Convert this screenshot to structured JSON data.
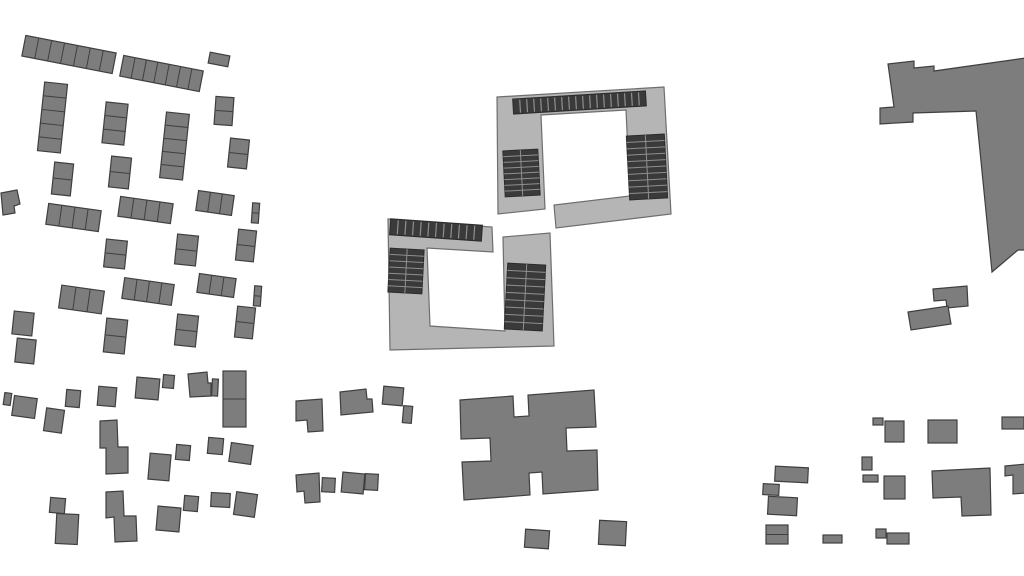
{
  "map": {
    "kind": "building-footprint-site-plan",
    "width": 1024,
    "height": 576,
    "background": "#ffffff"
  },
  "colors": {
    "building_fill": "#7d7d7d",
    "building_stroke": "#3f3f3f",
    "court_fill": "#b5b5b5",
    "court_stroke": "#6e6e6e",
    "panel_fill": "#3a3a3a",
    "panel_stroke": "#2b2b2b",
    "panel_divider": "#8f8f8f",
    "cell_divider": "#3f3f3f"
  },
  "buildings": [
    {
      "kind": "rect",
      "name": "terrace-row",
      "x": 23,
      "y": 44,
      "w": 92,
      "h": 21,
      "rot": 11,
      "cells": 7,
      "dir": "h"
    },
    {
      "kind": "rect",
      "name": "terrace-row",
      "x": 121,
      "y": 63,
      "w": 81,
      "h": 21,
      "rot": 11,
      "cells": 7,
      "dir": "h"
    },
    {
      "kind": "rect",
      "name": "detached-house",
      "x": 209,
      "y": 54,
      "w": 20,
      "h": 11,
      "rot": 11,
      "cells": 1,
      "dir": "h"
    },
    {
      "kind": "rect",
      "name": "terrace-column",
      "x": 41,
      "y": 83,
      "w": 23,
      "h": 69,
      "rot": 6,
      "cells": 5,
      "dir": "v"
    },
    {
      "kind": "rect",
      "name": "terrace-column",
      "x": 104,
      "y": 103,
      "w": 22,
      "h": 41,
      "rot": 6,
      "cells": 3,
      "dir": "v"
    },
    {
      "kind": "rect",
      "name": "terrace-column",
      "x": 163,
      "y": 113,
      "w": 23,
      "h": 66,
      "rot": 6,
      "cells": 5,
      "dir": "v"
    },
    {
      "kind": "rect",
      "name": "terrace-column",
      "x": 215,
      "y": 97,
      "w": 18,
      "h": 28,
      "rot": 4,
      "cells": 2,
      "dir": "v"
    },
    {
      "kind": "rect",
      "name": "terrace-column",
      "x": 229,
      "y": 139,
      "w": 19,
      "h": 29,
      "rot": 6,
      "cells": 2,
      "dir": "v"
    },
    {
      "kind": "rect",
      "name": "terrace-column",
      "x": 53,
      "y": 163,
      "w": 19,
      "h": 32,
      "rot": 6,
      "cells": 2,
      "dir": "v"
    },
    {
      "kind": "rect",
      "name": "terrace-column",
      "x": 110,
      "y": 157,
      "w": 20,
      "h": 31,
      "rot": 6,
      "cells": 2,
      "dir": "v"
    },
    {
      "kind": "rect",
      "name": "terrace-row",
      "x": 197,
      "y": 193,
      "w": 36,
      "h": 20,
      "rot": 8,
      "cells": 3,
      "dir": "h"
    },
    {
      "kind": "rect",
      "name": "terrace-column",
      "x": 252,
      "y": 203,
      "w": 7,
      "h": 20,
      "rot": 4,
      "cells": 2,
      "dir": "v"
    },
    {
      "kind": "rect",
      "name": "terrace-row",
      "x": 47,
      "y": 207,
      "w": 53,
      "h": 21,
      "rot": 8,
      "cells": 4,
      "dir": "h"
    },
    {
      "kind": "rect",
      "name": "terrace-row",
      "x": 119,
      "y": 200,
      "w": 53,
      "h": 20,
      "rot": 8,
      "cells": 4,
      "dir": "h"
    },
    {
      "kind": "rect",
      "name": "terrace-column",
      "x": 105,
      "y": 240,
      "w": 21,
      "h": 28,
      "rot": 6,
      "cells": 2,
      "dir": "v"
    },
    {
      "kind": "rect",
      "name": "terrace-column",
      "x": 176,
      "y": 235,
      "w": 21,
      "h": 30,
      "rot": 6,
      "cells": 2,
      "dir": "v"
    },
    {
      "kind": "rect",
      "name": "terrace-column",
      "x": 237,
      "y": 230,
      "w": 18,
      "h": 31,
      "rot": 6,
      "cells": 2,
      "dir": "v"
    },
    {
      "kind": "rect",
      "name": "terrace-row",
      "x": 60,
      "y": 288,
      "w": 43,
      "h": 23,
      "rot": 8,
      "cells": 3,
      "dir": "h"
    },
    {
      "kind": "rect",
      "name": "terrace-row",
      "x": 123,
      "y": 281,
      "w": 50,
      "h": 21,
      "rot": 8,
      "cells": 4,
      "dir": "h"
    },
    {
      "kind": "rect",
      "name": "terrace-row",
      "x": 198,
      "y": 276,
      "w": 37,
      "h": 19,
      "rot": 8,
      "cells": 3,
      "dir": "h"
    },
    {
      "kind": "rect",
      "name": "terrace-column",
      "x": 254,
      "y": 286,
      "w": 7,
      "h": 20,
      "rot": 4,
      "cells": 2,
      "dir": "v"
    },
    {
      "kind": "rect",
      "name": "detached-house",
      "x": 13,
      "y": 312,
      "w": 20,
      "h": 23,
      "rot": 6,
      "cells": 1,
      "dir": "v"
    },
    {
      "kind": "rect",
      "name": "detached-house",
      "x": 16,
      "y": 339,
      "w": 19,
      "h": 24,
      "rot": 6,
      "cells": 1,
      "dir": "v"
    },
    {
      "kind": "rect",
      "name": "terrace-column",
      "x": 105,
      "y": 319,
      "w": 21,
      "h": 34,
      "rot": 6,
      "cells": 2,
      "dir": "v"
    },
    {
      "kind": "rect",
      "name": "terrace-column",
      "x": 176,
      "y": 315,
      "w": 21,
      "h": 31,
      "rot": 6,
      "cells": 2,
      "dir": "v"
    },
    {
      "kind": "rect",
      "name": "terrace-column",
      "x": 236,
      "y": 307,
      "w": 18,
      "h": 31,
      "rot": 6,
      "cells": 2,
      "dir": "v"
    },
    {
      "kind": "poly",
      "name": "detached-house",
      "pts": [
        [
          1,
          193
        ],
        [
          17,
          190
        ],
        [
          20,
          204
        ],
        [
          14,
          206
        ],
        [
          15,
          213
        ],
        [
          3,
          215
        ]
      ]
    },
    {
      "kind": "poly",
      "name": "courtyard-building-north",
      "fill": "court",
      "pts": [
        [
          497,
          97
        ],
        [
          664,
          87
        ],
        [
          671,
          214
        ],
        [
          556,
          228
        ],
        [
          554,
          205
        ],
        [
          630,
          196
        ],
        [
          626,
          110
        ],
        [
          541,
          115
        ],
        [
          545,
          209
        ],
        [
          498,
          214
        ]
      ]
    },
    {
      "kind": "poly",
      "name": "courtyard-building-south",
      "fill": "court",
      "pts": [
        [
          388,
          219
        ],
        [
          492,
          227
        ],
        [
          493,
          252
        ],
        [
          427,
          248
        ],
        [
          430,
          326
        ],
        [
          505,
          331
        ],
        [
          503,
          237
        ],
        [
          550,
          233
        ],
        [
          554,
          346
        ],
        [
          390,
          350
        ]
      ]
    },
    {
      "kind": "panel-strip",
      "name": "solar-panel-strip-north",
      "x": 513,
      "y": 95,
      "w": 133,
      "h": 15,
      "rot": -3.5,
      "n": 19
    },
    {
      "kind": "panel-block",
      "name": "solar-panel-block-north-west",
      "x": 504,
      "y": 150,
      "w": 35,
      "h": 46,
      "rot": -3,
      "rows": 8,
      "cols": 2
    },
    {
      "kind": "panel-block",
      "name": "solar-panel-block-north-east",
      "x": 628,
      "y": 135,
      "w": 38,
      "h": 64,
      "rot": -3,
      "rows": 10,
      "cols": 2
    },
    {
      "kind": "panel-strip",
      "name": "solar-panel-strip-south",
      "x": 390,
      "y": 222,
      "w": 92,
      "h": 16,
      "rot": 4,
      "n": 12
    },
    {
      "kind": "panel-block",
      "name": "solar-panel-block-south-west",
      "x": 389,
      "y": 249,
      "w": 34,
      "h": 44,
      "rot": 3,
      "rows": 7,
      "cols": 2
    },
    {
      "kind": "panel-block",
      "name": "solar-panel-block-south-east",
      "x": 506,
      "y": 264,
      "w": 38,
      "h": 66,
      "rot": 3,
      "rows": 9,
      "cols": 2
    },
    {
      "kind": "poly",
      "name": "cross-shaped-building",
      "pts": [
        [
          460,
          400
        ],
        [
          513,
          396
        ],
        [
          514,
          417
        ],
        [
          529,
          416
        ],
        [
          528,
          395
        ],
        [
          594,
          390
        ],
        [
          596,
          427
        ],
        [
          566,
          428
        ],
        [
          567,
          451
        ],
        [
          597,
          450
        ],
        [
          598,
          490
        ],
        [
          543,
          494
        ],
        [
          542,
          472
        ],
        [
          529,
          473
        ],
        [
          530,
          495
        ],
        [
          464,
          500
        ],
        [
          462,
          462
        ],
        [
          491,
          461
        ],
        [
          490,
          438
        ],
        [
          461,
          439
        ]
      ]
    },
    {
      "kind": "poly",
      "name": "l-shaped-building-east",
      "pts": [
        [
          888,
          64
        ],
        [
          914,
          61
        ],
        [
          914,
          68
        ],
        [
          934,
          66
        ],
        [
          934,
          71
        ],
        [
          1026,
          58
        ],
        [
          1026,
          250
        ],
        [
          1018,
          250
        ],
        [
          992,
          272
        ],
        [
          976,
          111
        ],
        [
          913,
          113
        ],
        [
          913,
          122
        ],
        [
          880,
          124
        ],
        [
          880,
          108
        ],
        [
          894,
          107
        ]
      ]
    },
    {
      "kind": "poly",
      "name": "annex-building",
      "pts": [
        [
          933,
          289
        ],
        [
          967,
          286
        ],
        [
          968,
          306
        ],
        [
          947,
          308
        ],
        [
          946,
          300
        ],
        [
          934,
          301
        ]
      ]
    },
    {
      "kind": "poly",
      "name": "annex-building",
      "pts": [
        [
          908,
          312
        ],
        [
          948,
          306
        ],
        [
          951,
          324
        ],
        [
          911,
          330
        ]
      ]
    },
    {
      "kind": "rect",
      "name": "detached-house",
      "x": 4,
      "y": 393,
      "w": 7,
      "h": 12,
      "rot": 8
    },
    {
      "kind": "rect",
      "name": "detached-house",
      "x": 13,
      "y": 397,
      "w": 23,
      "h": 20,
      "rot": 8
    },
    {
      "kind": "rect",
      "name": "detached-house",
      "x": 45,
      "y": 409,
      "w": 18,
      "h": 23,
      "rot": 8
    },
    {
      "kind": "rect",
      "name": "detached-house",
      "x": 66,
      "y": 390,
      "w": 14,
      "h": 17,
      "rot": 5
    },
    {
      "kind": "rect",
      "name": "detached-house",
      "x": 98,
      "y": 387,
      "w": 18,
      "h": 19,
      "rot": 5
    },
    {
      "kind": "rect",
      "name": "detached-house",
      "x": 136,
      "y": 378,
      "w": 23,
      "h": 21,
      "rot": 5
    },
    {
      "kind": "rect",
      "name": "detached-house",
      "x": 163,
      "y": 375,
      "w": 11,
      "h": 13,
      "rot": 5
    },
    {
      "kind": "poly",
      "name": "detached-house",
      "pts": [
        [
          188,
          374
        ],
        [
          207,
          372
        ],
        [
          208,
          383
        ],
        [
          211,
          383
        ],
        [
          211,
          396
        ],
        [
          190,
          397
        ]
      ]
    },
    {
      "kind": "rect",
      "name": "detached-house",
      "x": 212,
      "y": 379,
      "w": 6,
      "h": 17,
      "rot": 3
    },
    {
      "kind": "rect",
      "name": "detached-house",
      "x": 223,
      "y": 371,
      "w": 23,
      "h": 56,
      "rot": 0,
      "cells": 2,
      "dir": "v"
    },
    {
      "kind": "poly",
      "name": "detached-house",
      "pts": [
        [
          100,
          421
        ],
        [
          117,
          420
        ],
        [
          118,
          447
        ],
        [
          128,
          447
        ],
        [
          128,
          473
        ],
        [
          106,
          474
        ],
        [
          106,
          448
        ],
        [
          100,
          448
        ]
      ]
    },
    {
      "kind": "rect",
      "name": "detached-house",
      "x": 149,
      "y": 454,
      "w": 21,
      "h": 26,
      "rot": 5
    },
    {
      "kind": "rect",
      "name": "detached-house",
      "x": 176,
      "y": 445,
      "w": 14,
      "h": 15,
      "rot": 5
    },
    {
      "kind": "rect",
      "name": "detached-house",
      "x": 208,
      "y": 438,
      "w": 15,
      "h": 16,
      "rot": 5
    },
    {
      "kind": "rect",
      "name": "detached-house",
      "x": 230,
      "y": 444,
      "w": 22,
      "h": 19,
      "rot": 8
    },
    {
      "kind": "rect",
      "name": "detached-house",
      "x": 50,
      "y": 498,
      "w": 15,
      "h": 15,
      "rot": 5
    },
    {
      "kind": "rect",
      "name": "detached-house",
      "x": 56,
      "y": 514,
      "w": 22,
      "h": 30,
      "rot": 3
    },
    {
      "kind": "poly",
      "name": "detached-house",
      "pts": [
        [
          106,
          492
        ],
        [
          123,
          491
        ],
        [
          124,
          516
        ],
        [
          136,
          516
        ],
        [
          137,
          541
        ],
        [
          115,
          542
        ],
        [
          114,
          517
        ],
        [
          106,
          518
        ]
      ]
    },
    {
      "kind": "rect",
      "name": "detached-house",
      "x": 157,
      "y": 507,
      "w": 23,
      "h": 24,
      "rot": 5
    },
    {
      "kind": "rect",
      "name": "detached-house",
      "x": 184,
      "y": 496,
      "w": 14,
      "h": 15,
      "rot": 5
    },
    {
      "kind": "rect",
      "name": "detached-house",
      "x": 211,
      "y": 493,
      "w": 19,
      "h": 14,
      "rot": 3
    },
    {
      "kind": "rect",
      "name": "detached-house",
      "x": 235,
      "y": 493,
      "w": 21,
      "h": 23,
      "rot": 8
    },
    {
      "kind": "poly",
      "name": "detached-house",
      "pts": [
        [
          296,
          401
        ],
        [
          322,
          399
        ],
        [
          323,
          431
        ],
        [
          308,
          432
        ],
        [
          307,
          420
        ],
        [
          296,
          421
        ]
      ]
    },
    {
      "kind": "poly",
      "name": "detached-house",
      "pts": [
        [
          340,
          392
        ],
        [
          366,
          389
        ],
        [
          367,
          399
        ],
        [
          372,
          399
        ],
        [
          373,
          412
        ],
        [
          341,
          415
        ]
      ]
    },
    {
      "kind": "rect",
      "name": "detached-house",
      "x": 383,
      "y": 387,
      "w": 20,
      "h": 18,
      "rot": 5
    },
    {
      "kind": "rect",
      "name": "detached-house",
      "x": 403,
      "y": 406,
      "w": 9,
      "h": 17,
      "rot": 5
    },
    {
      "kind": "poly",
      "name": "detached-house",
      "pts": [
        [
          296,
          475
        ],
        [
          319,
          473
        ],
        [
          320,
          502
        ],
        [
          305,
          503
        ],
        [
          304,
          491
        ],
        [
          297,
          492
        ]
      ]
    },
    {
      "kind": "rect",
      "name": "detached-house",
      "x": 322,
      "y": 478,
      "w": 13,
      "h": 14,
      "rot": 3
    },
    {
      "kind": "rect",
      "name": "detached-house",
      "x": 342,
      "y": 473,
      "w": 22,
      "h": 20,
      "rot": 5
    },
    {
      "kind": "rect",
      "name": "detached-house",
      "x": 365,
      "y": 474,
      "w": 13,
      "h": 16,
      "rot": 3
    },
    {
      "kind": "rect",
      "name": "detached-house",
      "x": 525,
      "y": 530,
      "w": 24,
      "h": 18,
      "rot": 4
    },
    {
      "kind": "rect",
      "name": "detached-house",
      "x": 599,
      "y": 521,
      "w": 27,
      "h": 24,
      "rot": 3
    },
    {
      "kind": "rect",
      "name": "detached-house",
      "x": 873,
      "y": 418,
      "w": 10,
      "h": 7,
      "rot": 0
    },
    {
      "kind": "rect",
      "name": "detached-house",
      "x": 885,
      "y": 421,
      "w": 19,
      "h": 21,
      "rot": 0
    },
    {
      "kind": "rect",
      "name": "detached-house",
      "x": 928,
      "y": 420,
      "w": 29,
      "h": 23,
      "rot": 0
    },
    {
      "kind": "rect",
      "name": "detached-house",
      "x": 1002,
      "y": 417,
      "w": 22,
      "h": 12,
      "rot": 0
    },
    {
      "kind": "rect",
      "name": "detached-house",
      "x": 775,
      "y": 467,
      "w": 33,
      "h": 15,
      "rot": 3
    },
    {
      "kind": "rect",
      "name": "detached-house",
      "x": 763,
      "y": 484,
      "w": 16,
      "h": 11,
      "rot": 3
    },
    {
      "kind": "rect",
      "name": "detached-house",
      "x": 768,
      "y": 497,
      "w": 29,
      "h": 18,
      "rot": 3
    },
    {
      "kind": "rect",
      "name": "detached-house",
      "x": 766,
      "y": 525,
      "w": 22,
      "h": 19,
      "rot": 0,
      "cells": 2,
      "dir": "v"
    },
    {
      "kind": "rect",
      "name": "detached-house",
      "x": 823,
      "y": 535,
      "w": 19,
      "h": 8,
      "rot": 0
    },
    {
      "kind": "rect",
      "name": "detached-house",
      "x": 862,
      "y": 457,
      "w": 10,
      "h": 13,
      "rot": 0
    },
    {
      "kind": "rect",
      "name": "detached-house",
      "x": 863,
      "y": 475,
      "w": 15,
      "h": 7,
      "rot": 0
    },
    {
      "kind": "rect",
      "name": "detached-house",
      "x": 884,
      "y": 476,
      "w": 21,
      "h": 23,
      "rot": 0
    },
    {
      "kind": "rect",
      "name": "detached-house",
      "x": 876,
      "y": 529,
      "w": 10,
      "h": 9,
      "rot": 0
    },
    {
      "kind": "rect",
      "name": "detached-house",
      "x": 887,
      "y": 533,
      "w": 22,
      "h": 11,
      "rot": 0
    },
    {
      "kind": "poly",
      "name": "l-shaped-house",
      "pts": [
        [
          932,
          471
        ],
        [
          990,
          468
        ],
        [
          991,
          515
        ],
        [
          962,
          516
        ],
        [
          961,
          497
        ],
        [
          933,
          498
        ]
      ]
    },
    {
      "kind": "poly",
      "name": "l-shaped-house",
      "pts": [
        [
          1005,
          466
        ],
        [
          1026,
          464
        ],
        [
          1026,
          493
        ],
        [
          1013,
          494
        ],
        [
          1013,
          475
        ],
        [
          1005,
          476
        ]
      ]
    }
  ]
}
